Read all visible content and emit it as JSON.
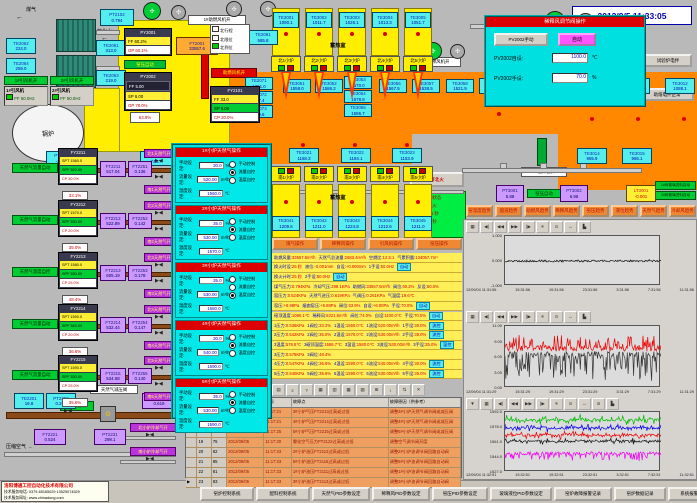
{
  "datetime": "2012/9/5 11:33:05",
  "labels": {
    "gas": "煤气",
    "soft_water": "软化水",
    "boiler": "锅炉",
    "regenerator_north": "蓄热室",
    "regenerator_south": "蓄热室",
    "air_fan_on": "1#助燃风机开",
    "damper": "助燃风机开",
    "dilution_fan1_on": "1#稀释风机开",
    "mixer2_on": "2#搅拌器开",
    "kiln_pressure_auto": "窑压自动",
    "kiln_pressure_auto2": "窑压自动",
    "dilution_auto": "稀释风自动",
    "compressed_air": "压缩空气",
    "gas_pr_valve": "天然气减压阀",
    "emergency_cut": "紧急切断",
    "north_cool": "北小炉冷却气开",
    "south_cool": "南小炉冷却气开",
    "pct_damper": "63.9%",
    "pct_dilution": "74.0%"
  },
  "fans_on": [
    "1#引风机开",
    "2#引风机开"
  ],
  "id_fans": [
    {
      "name": "1#引风机",
      "freq": "FF 50.0Hz"
    },
    {
      "name": "2#引风机",
      "freq": "FF 50.0Hz"
    }
  ],
  "legend": [
    "北行程",
    "北限位",
    "北到位"
  ],
  "panels": {
    "py2001": {
      "tag": "PY2001",
      "rows": [
        {
          "t": "FF 60.2%",
          "k": "rY"
        },
        {
          "t": "OP 60.1%",
          "k": "rW"
        }
      ]
    },
    "py2002": {
      "tag": "PY2002",
      "rows": [
        {
          "t": "FF 5.00",
          "k": "rD2"
        },
        {
          "t": "SP 6.00",
          "k": "rY"
        },
        {
          "t": "OP 78.0%",
          "k": "rW"
        }
      ]
    },
    "fy2101": {
      "tag": "FY2101",
      "rows": [
        {
          "t": "FF 33.0",
          "k": "rY"
        },
        {
          "t": "SP 5.00",
          "k": "rG"
        },
        {
          "t": "CP 20.0%",
          "k": "rW"
        }
      ]
    },
    "fv2002": {
      "tag": "FV2002",
      "rows": [
        {
          "t": "PV 1098.1",
          "k": "rD2"
        },
        {
          "t": "SP 1100.0",
          "k": "rY"
        },
        {
          "t": "CP 70.0%",
          "k": "rW"
        }
      ]
    }
  },
  "boxes": [
    {
      "tag": "PT2102",
      "val": "0.794",
      "k": "c"
    },
    {
      "tag": "TE2062",
      "val": "224.0",
      "k": "c"
    },
    {
      "tag": "TE2061",
      "val": "313.0",
      "k": "c"
    },
    {
      "tag": "TE2064",
      "val": "259.0",
      "k": "c"
    },
    {
      "tag": "TE2063",
      "val": "219.0",
      "k": "c"
    },
    {
      "tag": "TE2081",
      "val": "585.8",
      "k": "c"
    },
    {
      "tag": "FT2001",
      "val": "33557.6",
      "k": "o"
    },
    {
      "tag": "PT2003",
      "val": "-226.1",
      "k": "c"
    },
    {
      "tag": "TE2083",
      "val": "745.7",
      "k": "c"
    },
    {
      "tag": "TE2201",
      "val": "19.8",
      "k": "c"
    },
    {
      "tag": "PT2202",
      "val": "0.268",
      "k": "c"
    },
    {
      "tag": "FT2201",
      "val": "0.619",
      "k": "p"
    },
    {
      "tag": "FT2221",
      "val": "0.524",
      "k": "p"
    },
    {
      "tag": "PT2231",
      "val": "298.1",
      "k": "p"
    },
    {
      "tag": "PT3001",
      "val": "5.88",
      "k": "p"
    },
    {
      "tag": "PT3002",
      "val": "6.96",
      "k": "p"
    },
    {
      "tag": "LT3001",
      "val": "-0.001",
      "k": "y"
    },
    {
      "tag": "TE3009",
      "val": "1523.1",
      "k": "c"
    },
    {
      "tag": "TE3010",
      "val": "1081.1",
      "k": "c"
    },
    {
      "tag": "TE3011",
      "val": "1079.6",
      "k": "c"
    },
    {
      "tag": "TE3012",
      "val": "1088.1",
      "k": "c"
    },
    {
      "tag": "TE3014",
      "val": "965.9",
      "k": "c"
    },
    {
      "tag": "TE3015",
      "val": "965.1",
      "k": "c"
    },
    {
      "tag": "FT2002",
      "val": "6321.6",
      "k": "y"
    },
    {
      "tag": "TE2071",
      "val": "1251.0",
      "k": "c"
    },
    {
      "tag": "TE2072",
      "val": "287.4",
      "k": "c"
    },
    {
      "tag": "TE2073",
      "val": "249.6",
      "k": "c"
    },
    {
      "tag": "TE3051",
      "val": "1558.0",
      "k": "c"
    },
    {
      "tag": "TE3052",
      "val": "1586.2",
      "k": "c"
    },
    {
      "tag": "TE3053",
      "val": "1570.0",
      "k": "c"
    },
    {
      "tag": "TE3054",
      "val": "1578.8",
      "k": "c"
    },
    {
      "tag": "TE3055",
      "val": "1586.7",
      "k": "c"
    },
    {
      "tag": "TE3056",
      "val": "1567.5",
      "k": "c"
    },
    {
      "tag": "TE3057",
      "val": "1538.5",
      "k": "c"
    },
    {
      "tag": "TE3058",
      "val": "1521.9",
      "k": "c"
    },
    {
      "tag": "TE3021",
      "val": "1168.3",
      "k": "c"
    },
    {
      "tag": "TE3022",
      "val": "1184.1",
      "k": "c"
    },
    {
      "tag": "TE3023",
      "val": "1153.9",
      "k": "c"
    }
  ],
  "north_ports": [
    "北1小炉",
    "北2小炉",
    "北3小炉",
    "北4小炉",
    "北5小炉"
  ],
  "south_ports": [
    "南1小炉",
    "南2小炉",
    "南3小炉",
    "南4小炉",
    "南5小炉"
  ],
  "regen_top": [
    {
      "tag": "TE3001",
      "val": "1090.1"
    },
    {
      "tag": "TE3002",
      "val": "1011.7"
    },
    {
      "tag": "TE3003",
      "val": "1026.1"
    },
    {
      "tag": "TE3004",
      "val": "1013.3"
    },
    {
      "tag": "TE3005",
      "val": "1051.7"
    }
  ],
  "south_bottom": [
    {
      "tag": "TE3041",
      "val": "1209.6"
    },
    {
      "tag": "TE3042",
      "val": "1211.0"
    },
    {
      "tag": "TE3043",
      "val": "1224.8"
    },
    {
      "tag": "TE3044",
      "val": "1212.6"
    },
    {
      "tag": "TE3045",
      "val": "1211.0"
    }
  ],
  "fuel_branches": [
    {
      "mode": "天然气流量自动",
      "tag": "FY2211",
      "spt": "SPT 1560.0",
      "spf": "SPF 520.00",
      "cp": "CP 30.0%",
      "ft": "FT2211",
      "ftv": "517.04",
      "ft2": "FT2251",
      "ft2v": "0.136",
      "pct": "33.1%",
      "north": "北1天然气开",
      "south": "南1天然气开"
    },
    {
      "mode": "天然气流量自动",
      "tag": "FY2212",
      "spt": "SPT 1570.0",
      "spf": "SPF 530.00",
      "cp": "CP 20.0%",
      "ft": "FT2212",
      "ftv": "522.89",
      "ft2": "FT2252",
      "ft2v": "0.142",
      "pct": "35.0%",
      "north": "北2天然气开",
      "south": "南2天然气开"
    },
    {
      "mode": "天然气温度自控",
      "tag": "FY2213",
      "spt": "SPT 1580.0",
      "spf": "SPF 530.00",
      "cp": "CP 25.0%",
      "ft": "FT2213",
      "ftv": "605.19",
      "ft2": "FT2253",
      "ft2v": "0.178",
      "pct": "48.4%",
      "north": "北3天然气开",
      "south": "南3天然气开"
    },
    {
      "mode": "天然气流量自动",
      "tag": "FY2214",
      "spt": "SPT 1590.0",
      "spf": "SPF 540.00",
      "cp": "CP 20.0%",
      "ft": "FT2214",
      "ftv": "532.44",
      "ft2": "FT2254",
      "ft2v": "0.147",
      "pct": "36.6%",
      "north": "北4天然气开",
      "south": "南4天然气开"
    },
    {
      "mode": "天然气流量自动",
      "tag": "FY2215",
      "spt": "SPT 1590.0",
      "spf": "SPF 530.00",
      "cp": "CP 25.0%",
      "ft": "FT2215",
      "ftv": "534.58",
      "ft2": "FT2255",
      "ft2v": "0.140",
      "pct": "35.6%",
      "north": "北5天然气开",
      "south": "南5天然气开"
    }
  ],
  "popup": {
    "field_labels": [
      "手动设定:",
      "流量设定:",
      "温度设定:"
    ],
    "units": [
      "%",
      "m³/h",
      "℃"
    ],
    "radios": [
      "手动控制",
      "流量自控",
      "温度自控"
    ],
    "sections": [
      {
        "title": "1#小炉天然气操作",
        "manual": "30.0",
        "flow": "520.00",
        "temp": "1560.0",
        "sel": 1
      },
      {
        "title": "2#小炉天然气操作",
        "manual": "35.0",
        "flow": "530.00",
        "temp": "1570.0",
        "sel": 1
      },
      {
        "title": "3#小炉天然气操作",
        "manual": "35.0",
        "flow": "530.00",
        "temp": "1580.0",
        "sel": 2
      },
      {
        "title": "4#小炉天然气操作",
        "manual": "30.0",
        "flow": "540.00",
        "temp": "1590.0",
        "sel": 1
      },
      {
        "title": "5#小炉天然气操作",
        "manual": "35.0",
        "flow": "530.00",
        "temp": "1590.0",
        "sel": 1
      }
    ]
  },
  "dilution_popup": {
    "title": "稀释风调节阀操作",
    "manual_btn": "PV2002手动",
    "auto_btn": "自动",
    "rows": [
      {
        "label": "PV2002自设:",
        "val": "1100.0",
        "unit": "℃"
      },
      {
        "label": "PV2002手设:",
        "val": "70.0",
        "unit": "%"
      }
    ]
  },
  "top_right_buttons": [
    "试验炉电拌",
    "助熔电拌正常"
  ],
  "reversal": {
    "button": "开北火",
    "status": [
      "状态: 自动状态",
      "命令: 开北火",
      "定时: 1175 秒",
      "计时: 269 秒"
    ]
  },
  "feeders": [
    "1#碎玻璃进料自动",
    "2#碎玻璃进料自动"
  ],
  "mid_buttons": [
    "煤气操作",
    "稀释风操作",
    "引风机操作",
    "窑压操作"
  ],
  "trend_buttons": [
    "窑温度趋势",
    "烟道趋势",
    "助燃风趋势",
    "稀释风趋势",
    "窑压趋势",
    "液位趋势",
    "天然气趋势",
    "冷却风趋势"
  ],
  "data_panel": {
    "header": [
      "助燃风量:33557.6m³/h",
      "天然气总流量:2683.4m³/h",
      "空燃比:12.5:1",
      "气累积量:134057.7m³"
    ],
    "rows": [
      [
        "换火时设:25 秒",
        "液位:-0.001mm",
        "自设:+0.000mm",
        "1手设:50.0Hz",
        "自动"
      ],
      [
        "换火计时:25 秒",
        "2手设:50.0Hz",
        "自动"
      ],
      [
        "煤气压力:0.794KPa",
        "冷却气压:298.1KPa",
        "助燃风:33557.6m³/h",
        "阀位:60.2%",
        "反设:60.0%"
      ],
      [
        "窑压力:0.524KPa",
        "天然气进压:0.619KPa",
        "气调压:0.261KPa",
        "气温度:19.6℃"
      ],
      [
        "窑压:+6.98Pa",
        "烟囱窑压:+5.88Pa",
        "阀位:63.9%",
        "自设:+6.00Pa",
        "手设:70.0%",
        "自动"
      ],
      [
        "碹顶温度:1090.1℃",
        "稀释风:6321.6m³/h",
        "阀位:74.0%",
        "自设:1100.0℃",
        "手设:70.0%",
        "自动"
      ],
      [
        "1压力:0.536KPa",
        "1阀位:33.2%",
        "1温设:1560.0℃",
        "1流设:520.00m³/h",
        "1手设:30.0%",
        "流控"
      ],
      [
        "2压力:0.542KPa",
        "2阀位:35.0%",
        "2温设:1570.0℃",
        "2流设:530.00m³/h",
        "2手设:35.0%",
        "流控"
      ],
      [
        "3温度:578.8℃",
        "3碹顶温度:1586.7℃",
        "3温设:1580.0℃",
        "3流设:530.00m³/h",
        "3手设:35.0%",
        "温控"
      ],
      [
        "3压力:0.578KPa",
        "3阀位:48.4%"
      ],
      [
        "4压力:0.547KPa",
        "4阀位:36.6%",
        "4温设:1590.0℃",
        "4流设:540.00m³/h",
        "4手设:30.0%",
        "流控"
      ],
      [
        "5压力:0.540KPa",
        "5阀位:35.6%",
        "5温设:1590.0℃",
        "5流设:530.00m³/h",
        "5手设:35.0%",
        "流控"
      ]
    ]
  },
  "alarm": {
    "toolbar": [
      "▤",
      "≡",
      "?",
      "▦",
      "▥",
      "▦",
      "▧",
      "⊞",
      "↕",
      "⇅",
      "✕"
    ],
    "headers": [
      "",
      "",
      "日期",
      "时间",
      "故障点",
      "故障原因（供参考）"
    ],
    "rows": [
      [
        "16",
        "96",
        "2012/09/05",
        "11:17:21",
        "3#小炉气压FT2213过高或过低",
        "调整3#小炉天然气调节阀或减压阀"
      ],
      [
        "17",
        "84",
        "2012/09/05",
        "11:17:21",
        "4#小炉气压FT2214过高或过低",
        "调整4#小炉天然气调节阀或减压阀"
      ],
      [
        "18",
        "97",
        "2012/09/05",
        "11:17:25",
        "5#小炉气压FT2215过高或过低",
        "调整5#小炉天然气调节阀或减压阀"
      ],
      [
        "19",
        "75",
        "2012/09/05",
        "11:17:30",
        "雾化空气压力PT2122过高或过低",
        "调整空气调节阀开度"
      ],
      [
        "20",
        "82",
        "2012/09/05",
        "11:17:33",
        "2#小炉油压FT2112过高或过低",
        "调整2#小炉油调节阀回路自动阀"
      ],
      [
        "21",
        "85",
        "2012/09/05",
        "11:17:33",
        "5#小炉油压FT2115过高或过低",
        "调整5#小炉油调节阀回路自动阀"
      ],
      [
        "22",
        "81",
        "2012/09/05",
        "11:17:33",
        "1#小炉油压FT2111过高或过低",
        "调整1#小炉油调节阀回路自动阀"
      ],
      [
        "23",
        "83",
        "2012/09/05",
        "11:17:33",
        "3#小炉油压FT2113过高或过低",
        "调整3#小炉油调节阀回路自动阀"
      ]
    ],
    "selected_index": 7
  },
  "company": {
    "name": "洛阳博通工控自动化技术有限公司",
    "phone": "技术服务电话: 0379-65165029 13525074529",
    "web": "技术服务网址: www.chinadong.com"
  },
  "bottom_buttons": [
    "窑炉控制系统",
    "配料控制系统",
    "天然气PID参数设定",
    "稀释风PID参数设定",
    "窑压PID参数设定",
    "玻璃液位PID参数设定",
    "窑炉故障报警记录",
    "窑炉数据记录",
    "系统报警值设定"
  ],
  "chart_toolbars": {
    "basic": [
      "▦",
      "◀|",
      "◀◀",
      "▶▶",
      "|▶",
      "✳",
      "⊙",
      "↔",
      "▙"
    ],
    "extended": [
      "▼",
      "▦",
      "◀|",
      "◀◀",
      "▶▶",
      "|▶",
      "✳",
      "⊙",
      "↔",
      "⊘",
      "▙"
    ]
  },
  "chart_data": [
    {
      "type": "line",
      "ylim": [
        -1,
        1
      ],
      "yticks": [
        "1.000",
        "0.000",
        "-1.000"
      ],
      "x_labels": [
        "12/09/04 11:31:56",
        "15:31:56",
        "19:31:56",
        "23:31:56",
        "3:31:56",
        "7:31:56",
        "11:31:56"
      ],
      "series": [
        {
          "color": "#111111",
          "base": 0.0,
          "amp": 0.04,
          "spike": 0.08,
          "spike_prob": 0.05,
          "dir": 0
        }
      ]
    },
    {
      "type": "line",
      "ylim": [
        0,
        11
      ],
      "yticks": [
        "11.00",
        "9.00",
        "6.00",
        "3.00",
        "0.00"
      ],
      "x_labels": [
        "12/09/04 11:31:29",
        "15:31:29",
        "19:31:29",
        "23:31:29",
        "3:31:29",
        "7:31:29",
        "11:31:29"
      ],
      "series": [
        {
          "color": "#333333",
          "base": 6.0,
          "amp": 0.5,
          "spike": 4.5,
          "spike_prob": 0.45,
          "dir": -1
        },
        {
          "color": "#ee0000",
          "base": 7.0,
          "amp": 0.5,
          "spike": 2.2,
          "spike_prob": 0.35,
          "dir": 1
        }
      ]
    },
    {
      "type": "line",
      "ylim": [
        1527,
        1595
      ],
      "yticks": [
        "1592.0",
        "1578.0",
        "1561.0",
        "1544.0",
        "1527.0"
      ],
      "x_labels": [
        "12/09/04 11:32:51",
        "15:32:51",
        "19:32:51",
        "23:32:51",
        "3:32:51",
        "7:32:51",
        "11:32:51"
      ],
      "series": [
        {
          "color": "#00bb00",
          "base": 1586,
          "amp": 1.5,
          "spike": 5,
          "spike_prob": 0.3,
          "dir": 0
        },
        {
          "color": "#0000ee",
          "base": 1577,
          "amp": 1.5,
          "spike": 4,
          "spike_prob": 0.3,
          "dir": 0
        },
        {
          "color": "#ee0000",
          "base": 1569,
          "amp": 1.5,
          "spike": 4,
          "spike_prob": 0.3,
          "dir": 0
        },
        {
          "color": "#111111",
          "base": 1562,
          "amp": 1.2,
          "spike": 3,
          "spike_prob": 0.3,
          "dir": 0
        },
        {
          "color": "#ee00ee",
          "base": 1548,
          "amp": 2.0,
          "spike": 7,
          "spike_prob": 0.35,
          "dir": -1
        }
      ]
    }
  ]
}
